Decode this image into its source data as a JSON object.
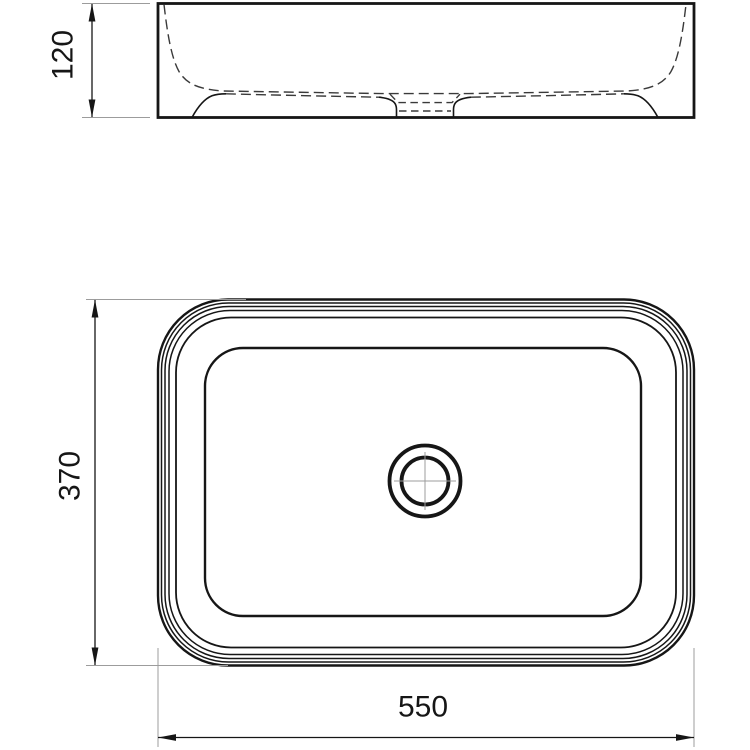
{
  "drawing": {
    "description": "Technical dimension drawing of a rectangular countertop washbasin shown in front elevation (top) and plan view (bottom) with a central drain",
    "views": [
      {
        "id": "front-elevation",
        "position": "top"
      },
      {
        "id": "plan-view",
        "position": "bottom"
      }
    ]
  },
  "labels": {
    "height": "120",
    "depth": "370",
    "width": "550"
  },
  "colors": {
    "line": "#161616",
    "hidden_line": "#3a3a3a",
    "extension_line": "#9c9c9c",
    "background": "#ffffff"
  }
}
